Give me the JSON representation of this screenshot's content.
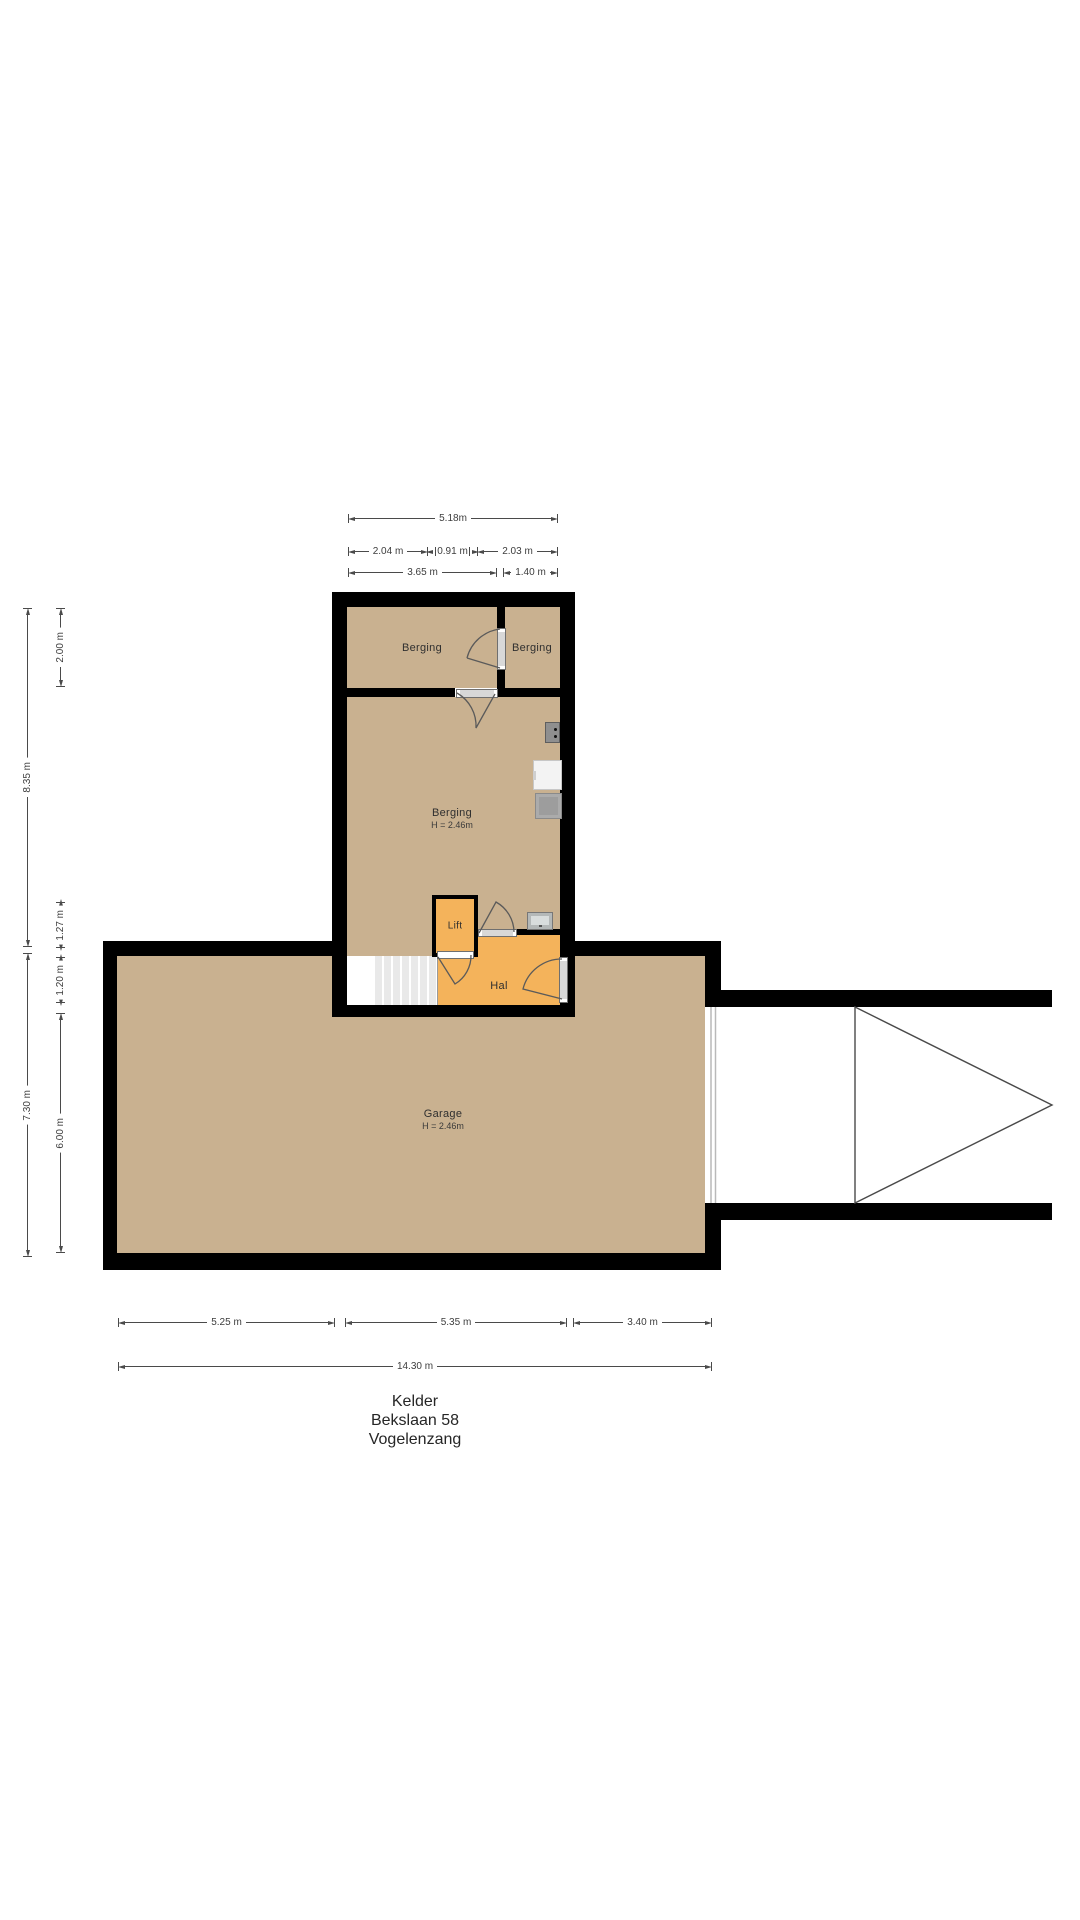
{
  "title": {
    "floor": "Kelder",
    "address": "Bekslaan 58",
    "city": "Vogelenzang"
  },
  "rooms": {
    "berging_left": {
      "name": "Berging"
    },
    "berging_right": {
      "name": "Berging"
    },
    "berging_main": {
      "name": "Berging",
      "ceiling_height": "H = 2.46m"
    },
    "lift": {
      "name": "Lift"
    },
    "hal": {
      "name": "Hal"
    },
    "garage": {
      "name": "Garage",
      "ceiling_height": "H = 2.46m"
    }
  },
  "dimensions": {
    "top": [
      {
        "label": "5.18m"
      },
      {
        "label": "2.04 m"
      },
      {
        "label": "0.91 m"
      },
      {
        "label": "2.03 m"
      },
      {
        "label": "3.65 m"
      },
      {
        "label": "1.40 m"
      }
    ],
    "left": [
      {
        "label": "8.35 m"
      },
      {
        "label": "2.00 m"
      },
      {
        "label": "1.27 m"
      },
      {
        "label": "1.20 m"
      },
      {
        "label": "7.30 m"
      },
      {
        "label": "6.00 m"
      }
    ],
    "bottom": [
      {
        "label": "5.25 m"
      },
      {
        "label": "5.35 m"
      },
      {
        "label": "3.40 m"
      },
      {
        "label": "14.30 m"
      }
    ]
  },
  "icons": {
    "consumer_unit": "dark wall box with two dots",
    "washer": "white appliance box",
    "dryer": "gray appliance box",
    "meter_box": "gray meter panel near hal",
    "driveway_arrow": "triangle pointing right",
    "garage_door": "double gray line in wall opening"
  },
  "colors": {
    "floor_tan": "#c9b190",
    "accent_orange": "#f4b35b",
    "wall_black": "#000000",
    "dim_ink": "#3d3d3d",
    "door_gray": "#d8d8d8",
    "stair_tread": "#e9e9e9"
  }
}
